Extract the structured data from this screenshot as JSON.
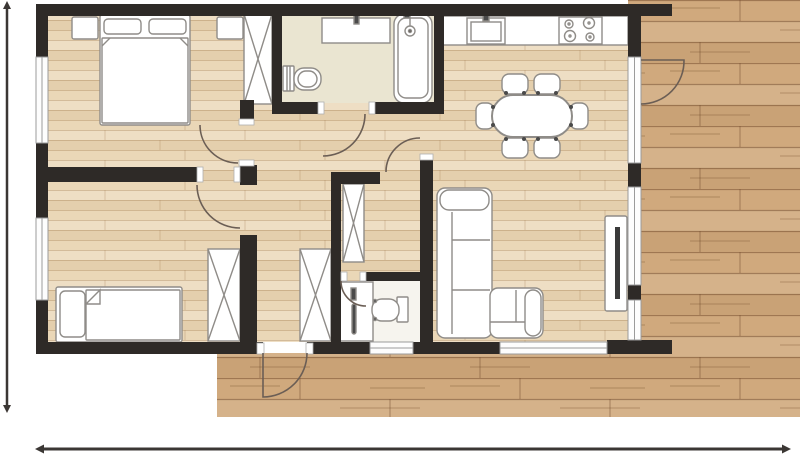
{
  "canvas": {
    "width": 800,
    "height": 456
  },
  "colors": {
    "background": "#ffffff",
    "wall": "#2e2a27",
    "interior_floor": "#ead7b7",
    "bathroom_tile": "#eae5d1",
    "wc_floor": "#f6f4ee",
    "deck": "#d0a97d",
    "furniture_fill": "#ffffff",
    "furniture_stroke": "#8f8c88",
    "window_fill": "#fdfdfd",
    "window_stroke": "#9b9b9b",
    "door_arc": "#6b5e55",
    "dimension": "#3b3734",
    "fixture_dark": "#4a4a4a",
    "tv_dark": "#3a3a3a"
  },
  "plan": {
    "type": "apartment-floor-plan",
    "rooms": [
      "bedroom-1",
      "bathroom",
      "kitchen-dining",
      "hallway",
      "bedroom-2",
      "wc",
      "living-room",
      "terrace-deck"
    ],
    "furniture_symbols": [
      "double-bed",
      "nightstand",
      "wardrobe",
      "vanity-counter",
      "bathtub",
      "shower-head",
      "toilet",
      "kitchen-counter",
      "kitchen-sink",
      "cooktop",
      "dining-table",
      "dining-chair",
      "single-bed",
      "washbasin",
      "corner-sofa",
      "tv-panel"
    ],
    "door_symbols": 7,
    "window_symbols": 7
  },
  "dimension_lines": {
    "left": "vertical extent arrow (no numeric label shown)",
    "bottom": "horizontal extent arrow (no numeric label shown)"
  }
}
